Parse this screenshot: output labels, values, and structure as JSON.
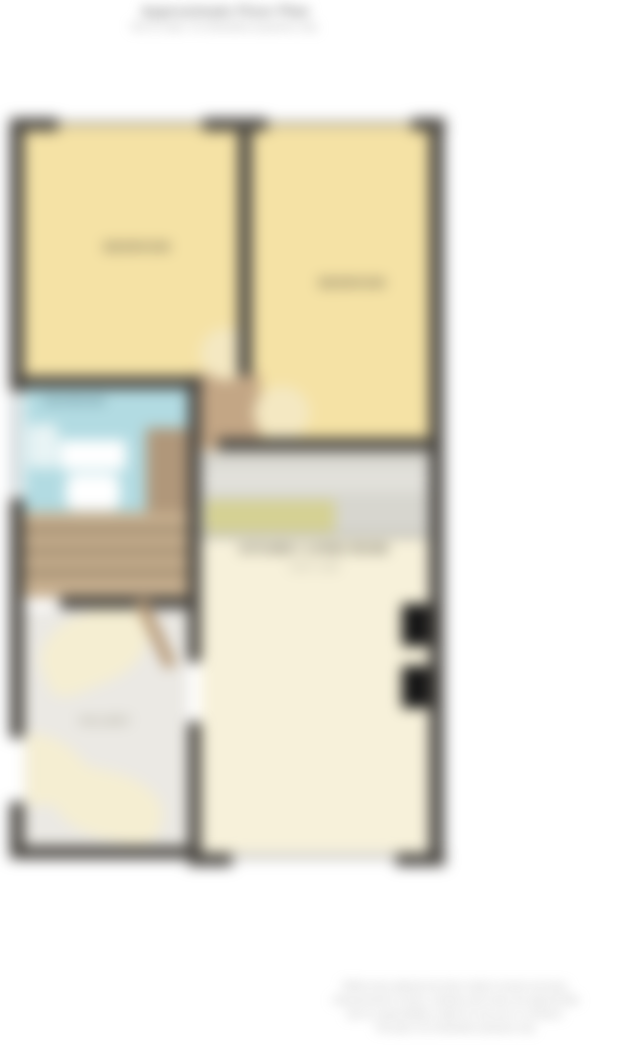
{
  "title": {
    "line1": "Approximate Floor Plan",
    "line2": "Not to scale. For illustrative purposes only."
  },
  "floorplan": {
    "rooms": {
      "bedroom1": {
        "label": "BEDROOM"
      },
      "bedroom2": {
        "label": "BEDROOM"
      },
      "bathroom": {
        "label": "BATHROOM"
      },
      "kitchen_living": {
        "label": "KITCHEN / LIVING ROOM",
        "dims": "4.90 x 3.80"
      },
      "hallway": {
        "label": "HALLWAY"
      }
    },
    "colors": {
      "wall": "#4b4843",
      "bedroom_fill": "#f5e2a5",
      "living_fill": "#f7f1da",
      "bathroom_fill": "#b2dbe2",
      "stairs_fill": "#c6ae8e",
      "counter_fill": "#d7d6cf",
      "olive_accent": "#d5d193",
      "chimney": "#151515"
    }
  },
  "disclaimer": {
    "lines": [
      "Whilst every attempt has been made to ensure accuracy,",
      "measurements of doors, windows and rooms are approximate",
      "and no responsibility is taken for any error or omission.",
      "This plan is for illustrative purposes only."
    ]
  }
}
